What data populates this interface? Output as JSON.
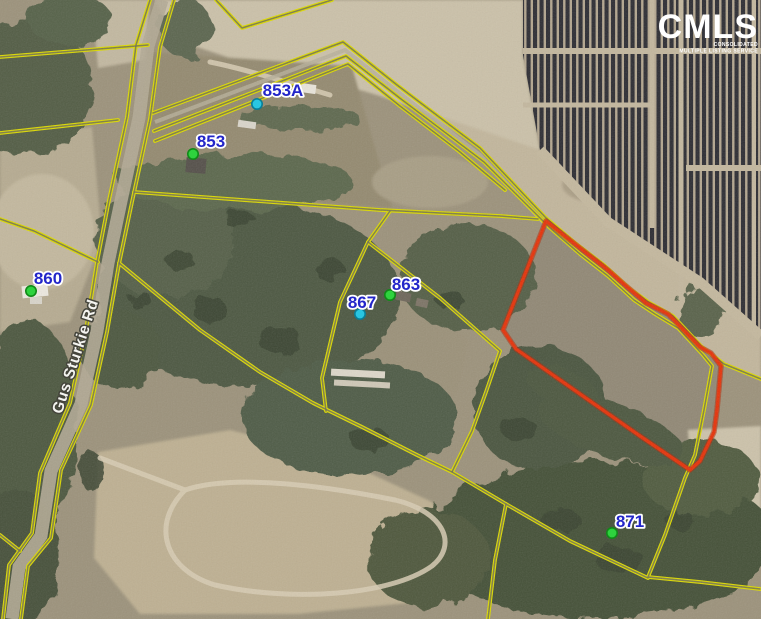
{
  "map": {
    "road_label": "Gus Sturkie Rd",
    "markers": [
      {
        "label": "853A",
        "dot": "cyan"
      },
      {
        "label": "853",
        "dot": "green"
      },
      {
        "label": "860",
        "dot": "green"
      },
      {
        "label": "863",
        "dot": "green"
      },
      {
        "label": "867",
        "dot": "cyan"
      },
      {
        "label": "871",
        "dot": "green"
      }
    ],
    "marker_colors": {
      "green": "#2ed33e",
      "cyan": "#29c6e2"
    },
    "label_color": "#2326c9",
    "parcel_line_color": "#dcd900",
    "highlight_outline_color": "#e5330a"
  },
  "logo": {
    "name": "CMLS",
    "tagline_line1": "CONSOLIDATED",
    "tagline_line2": "MULTIPLE LISTING SERVICE"
  }
}
